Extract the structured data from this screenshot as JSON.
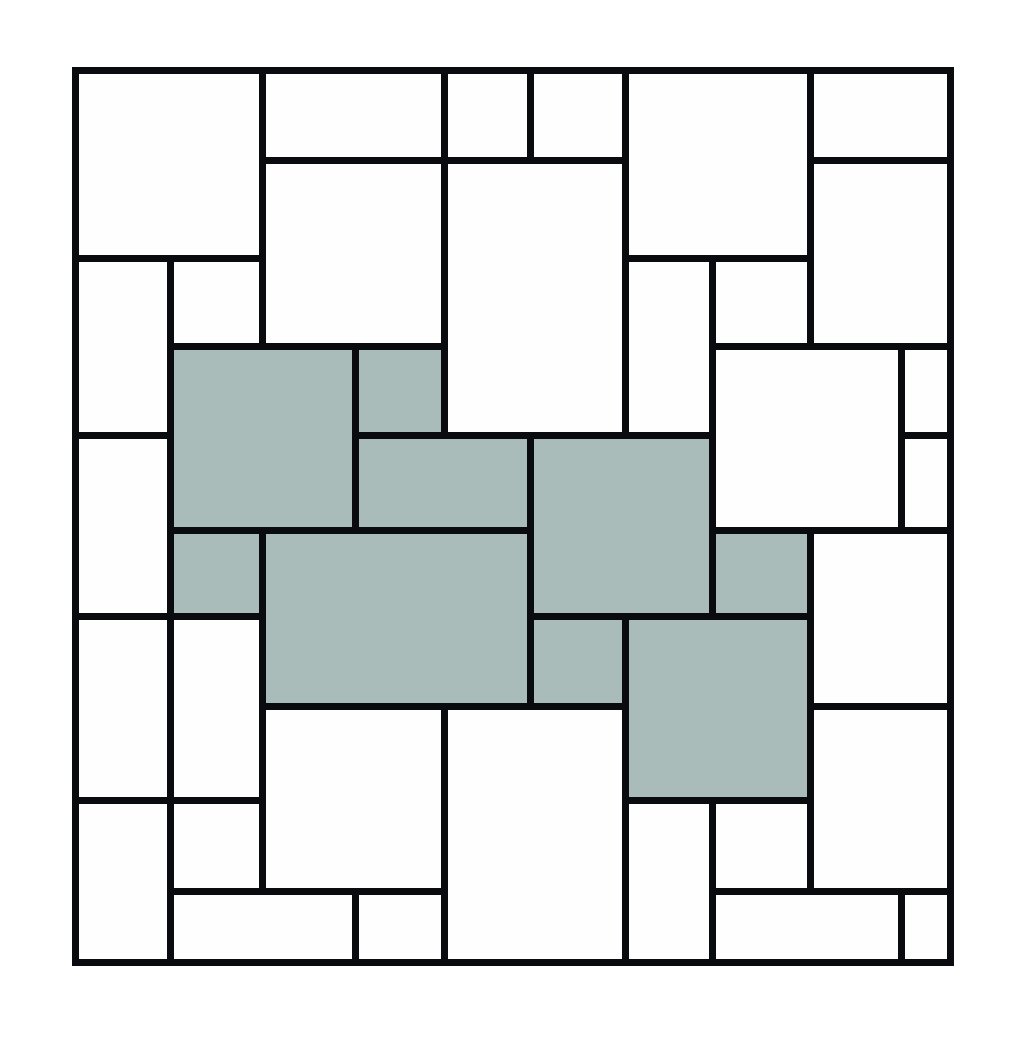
{
  "diagram": {
    "page_background": "#ffffff",
    "line_color": "#0a0b0e",
    "line_width": 7,
    "cell_fill": "#fefefe",
    "shaded_fill": "#a9bcb9",
    "v_lines": [
      75,
      170,
      262,
      355,
      444,
      530,
      625,
      712,
      810,
      901,
      950
    ],
    "h_lines": [
      70,
      160,
      258,
      346,
      435,
      530,
      616,
      706,
      800,
      891,
      962
    ],
    "cells": [
      {
        "c": 0,
        "r": 0,
        "cs": 2,
        "rs": 2,
        "shaded": false
      },
      {
        "c": 2,
        "r": 0,
        "cs": 2,
        "rs": 1,
        "shaded": false
      },
      {
        "c": 4,
        "r": 0,
        "cs": 1,
        "rs": 1,
        "shaded": false
      },
      {
        "c": 5,
        "r": 0,
        "cs": 1,
        "rs": 1,
        "shaded": false
      },
      {
        "c": 6,
        "r": 0,
        "cs": 2,
        "rs": 2,
        "shaded": false
      },
      {
        "c": 8,
        "r": 0,
        "cs": 2,
        "rs": 1,
        "shaded": false
      },
      {
        "c": 2,
        "r": 1,
        "cs": 2,
        "rs": 2,
        "shaded": false
      },
      {
        "c": 4,
        "r": 1,
        "cs": 2,
        "rs": 3,
        "shaded": false
      },
      {
        "c": 8,
        "r": 1,
        "cs": 2,
        "rs": 2,
        "shaded": false
      },
      {
        "c": 0,
        "r": 2,
        "cs": 1,
        "rs": 2,
        "shaded": false
      },
      {
        "c": 1,
        "r": 2,
        "cs": 1,
        "rs": 1,
        "shaded": false
      },
      {
        "c": 6,
        "r": 2,
        "cs": 1,
        "rs": 2,
        "shaded": false
      },
      {
        "c": 7,
        "r": 2,
        "cs": 1,
        "rs": 1,
        "shaded": false
      },
      {
        "c": 1,
        "r": 3,
        "cs": 2,
        "rs": 2,
        "shaded": true
      },
      {
        "c": 3,
        "r": 3,
        "cs": 1,
        "rs": 1,
        "shaded": true
      },
      {
        "c": 7,
        "r": 3,
        "cs": 2,
        "rs": 2,
        "shaded": false
      },
      {
        "c": 9,
        "r": 3,
        "cs": 1,
        "rs": 1,
        "shaded": false
      },
      {
        "c": 9,
        "r": 4,
        "cs": 1,
        "rs": 1,
        "shaded": false
      },
      {
        "c": 3,
        "r": 4,
        "cs": 2,
        "rs": 1,
        "shaded": true
      },
      {
        "c": 5,
        "r": 4,
        "cs": 2,
        "rs": 2,
        "shaded": true
      },
      {
        "c": 0,
        "r": 4,
        "cs": 1,
        "rs": 2,
        "shaded": false
      },
      {
        "c": 1,
        "r": 5,
        "cs": 1,
        "rs": 1,
        "shaded": true
      },
      {
        "c": 2,
        "r": 5,
        "cs": 3,
        "rs": 2,
        "shaded": true
      },
      {
        "c": 7,
        "r": 5,
        "cs": 1,
        "rs": 1,
        "shaded": true
      },
      {
        "c": 8,
        "r": 5,
        "cs": 2,
        "rs": 2,
        "shaded": false
      },
      {
        "c": 0,
        "r": 6,
        "cs": 1,
        "rs": 2,
        "shaded": false
      },
      {
        "c": 1,
        "r": 6,
        "cs": 1,
        "rs": 2,
        "shaded": false
      },
      {
        "c": 5,
        "r": 6,
        "cs": 1,
        "rs": 1,
        "shaded": true
      },
      {
        "c": 6,
        "r": 6,
        "cs": 2,
        "rs": 2,
        "shaded": true
      },
      {
        "c": 2,
        "r": 7,
        "cs": 2,
        "rs": 2,
        "shaded": false
      },
      {
        "c": 4,
        "r": 7,
        "cs": 2,
        "rs": 3,
        "shaded": false
      },
      {
        "c": 8,
        "r": 7,
        "cs": 2,
        "rs": 2,
        "shaded": false
      },
      {
        "c": 0,
        "r": 8,
        "cs": 1,
        "rs": 2,
        "shaded": false
      },
      {
        "c": 1,
        "r": 8,
        "cs": 1,
        "rs": 1,
        "shaded": false
      },
      {
        "c": 6,
        "r": 8,
        "cs": 1,
        "rs": 2,
        "shaded": false
      },
      {
        "c": 7,
        "r": 8,
        "cs": 1,
        "rs": 1,
        "shaded": false
      },
      {
        "c": 1,
        "r": 9,
        "cs": 2,
        "rs": 1,
        "shaded": false
      },
      {
        "c": 3,
        "r": 9,
        "cs": 1,
        "rs": 1,
        "shaded": false
      },
      {
        "c": 7,
        "r": 9,
        "cs": 2,
        "rs": 1,
        "shaded": false
      },
      {
        "c": 9,
        "r": 9,
        "cs": 1,
        "rs": 1,
        "shaded": false
      }
    ]
  }
}
